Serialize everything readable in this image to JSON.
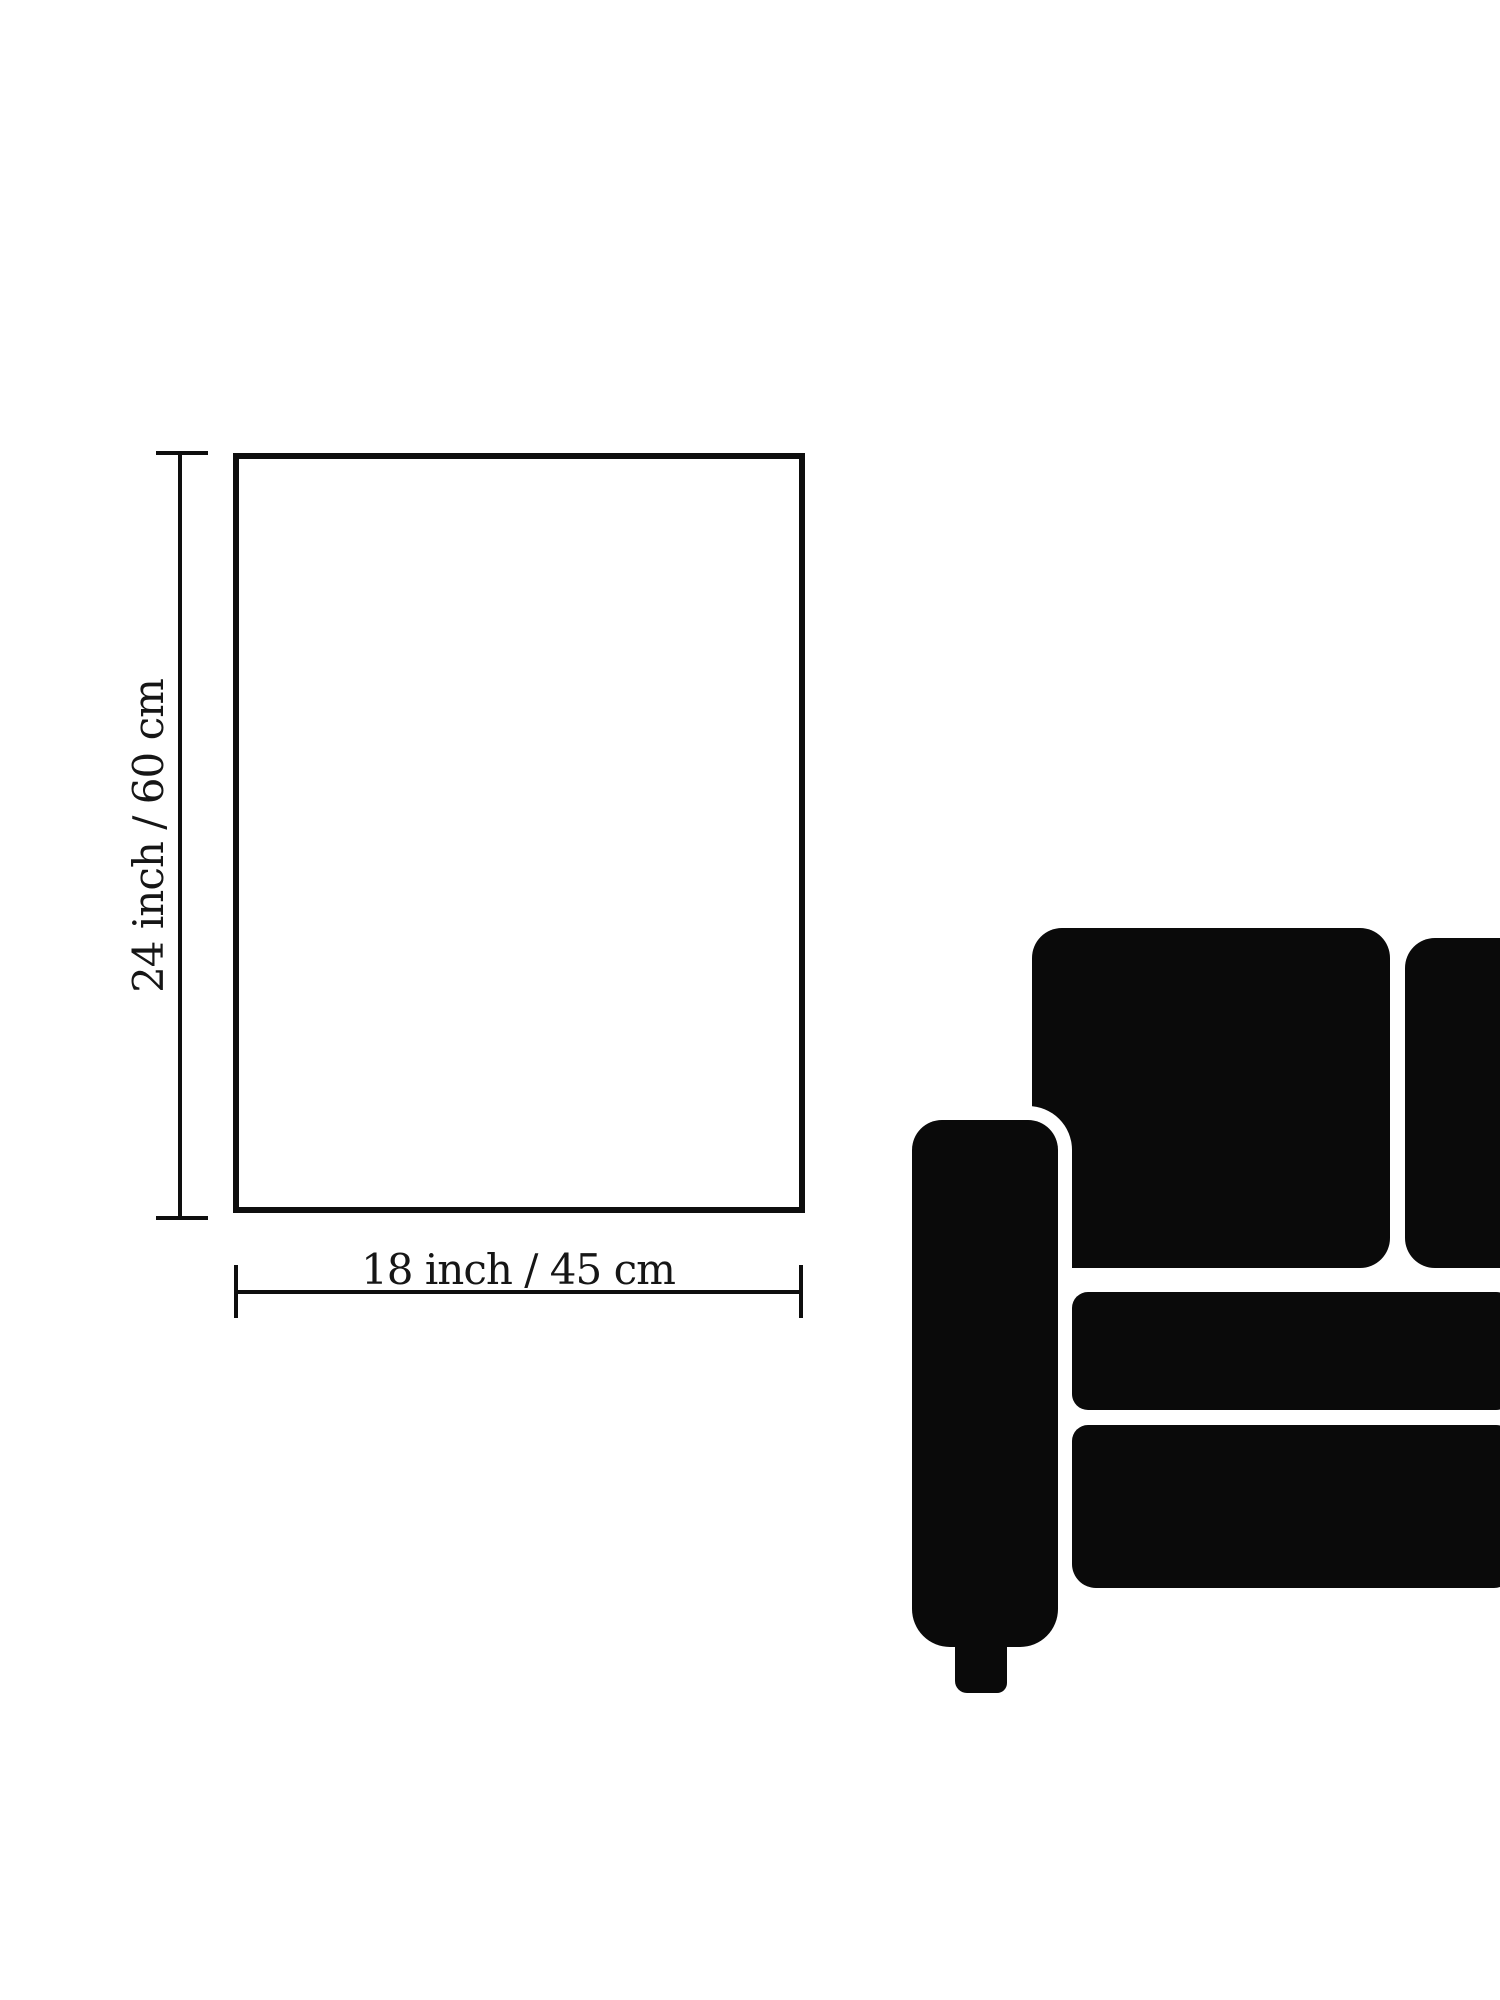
{
  "page": {
    "background_color": "#ffffff",
    "ink_color": "#0e0e0e",
    "text_color": "#161616"
  },
  "diagram": {
    "frame_icon": "poster-frame-outline",
    "height_label": "24 inch / 60 cm",
    "width_label": "18 inch / 45 cm"
  },
  "sofa": {
    "icon": "sofa-silhouette",
    "color": "#0a0a0a",
    "parts": [
      "backrest-cushion-left",
      "backrest-cushion-right",
      "seat-cushion-top",
      "seat-cushion-bottom",
      "armrest",
      "foot"
    ]
  }
}
